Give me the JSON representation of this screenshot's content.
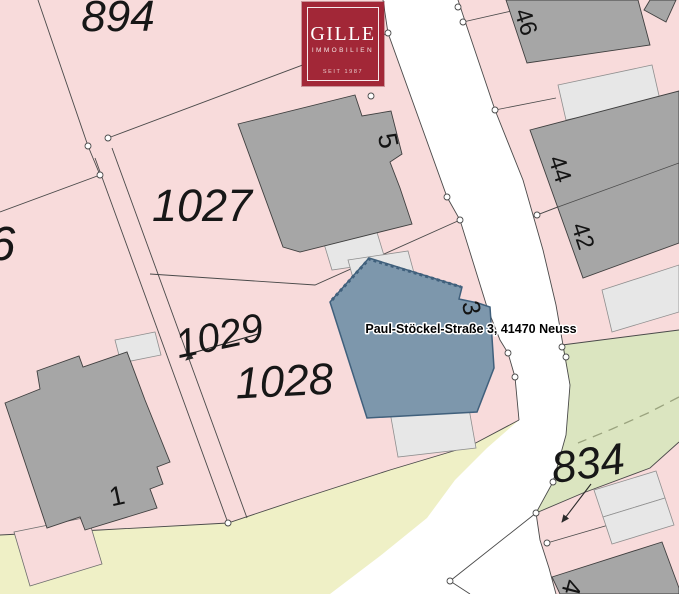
{
  "logo": {
    "brand": "GILLE",
    "subtitle": "IMMOBILIEN",
    "tagline": "SEIT 1987",
    "background": "#a22737"
  },
  "map": {
    "address_label": "Paul-Stöckel-Straße 3, 41470 Neuss",
    "parcels": {
      "p894": "894",
      "p1027": "1027",
      "p6": "6",
      "p1029": "1029",
      "p1028": "1028",
      "p834": "834"
    },
    "buildings": {
      "b5": "5",
      "b3": "3",
      "b1": "1",
      "b46": "46",
      "b44": "44",
      "b42": "42",
      "b4": "4"
    },
    "colors": {
      "parcel_pink": "#f8dbdb",
      "building_gray": "#a6a6a6",
      "annex_gray": "#e7e7e7",
      "highlight_blue": "#7d97ac",
      "highlight_border": "#40607c",
      "green_area": "#dbe5c0",
      "verge_yellow": "#eff0c6",
      "boundary_line": "#4a4a4a"
    }
  }
}
